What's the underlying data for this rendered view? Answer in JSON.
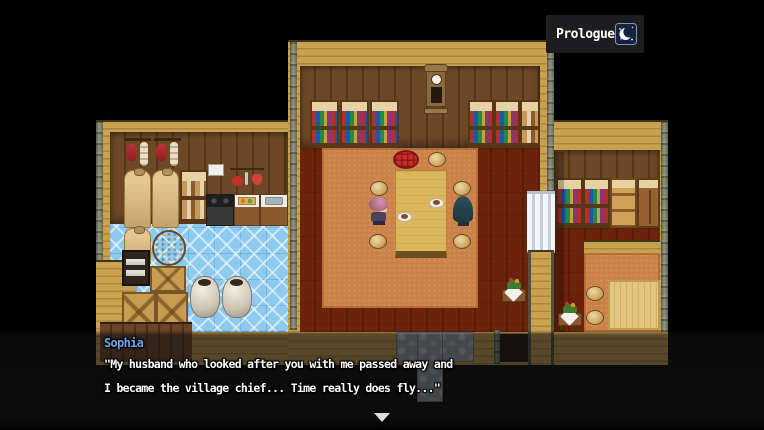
{
  "hud": {
    "chapter_label": "Prologue",
    "time_icon": "moon-icon"
  },
  "dialogue": {
    "speaker": "Sophia",
    "speaker_color": "#6fa4e9",
    "lines": [
      "\"My husband who looked after you with me passed away and",
      "I became the village chief... Time really does fly...\""
    ],
    "continue_indicator": "down-triangle-icon"
  },
  "colors": {
    "background": "#000000",
    "exterior_wall": "#c8a24e",
    "interior_wall": "#6c4827",
    "floor_planks": "#a55e35",
    "dining_carpet": "#cb8148",
    "kitchen_tile": "#8ccaef",
    "stone_path": "#9aa0a6",
    "dialogue_overlay": "rgba(18,18,18,0.64)",
    "hud_badge": "#1d1d1f"
  }
}
